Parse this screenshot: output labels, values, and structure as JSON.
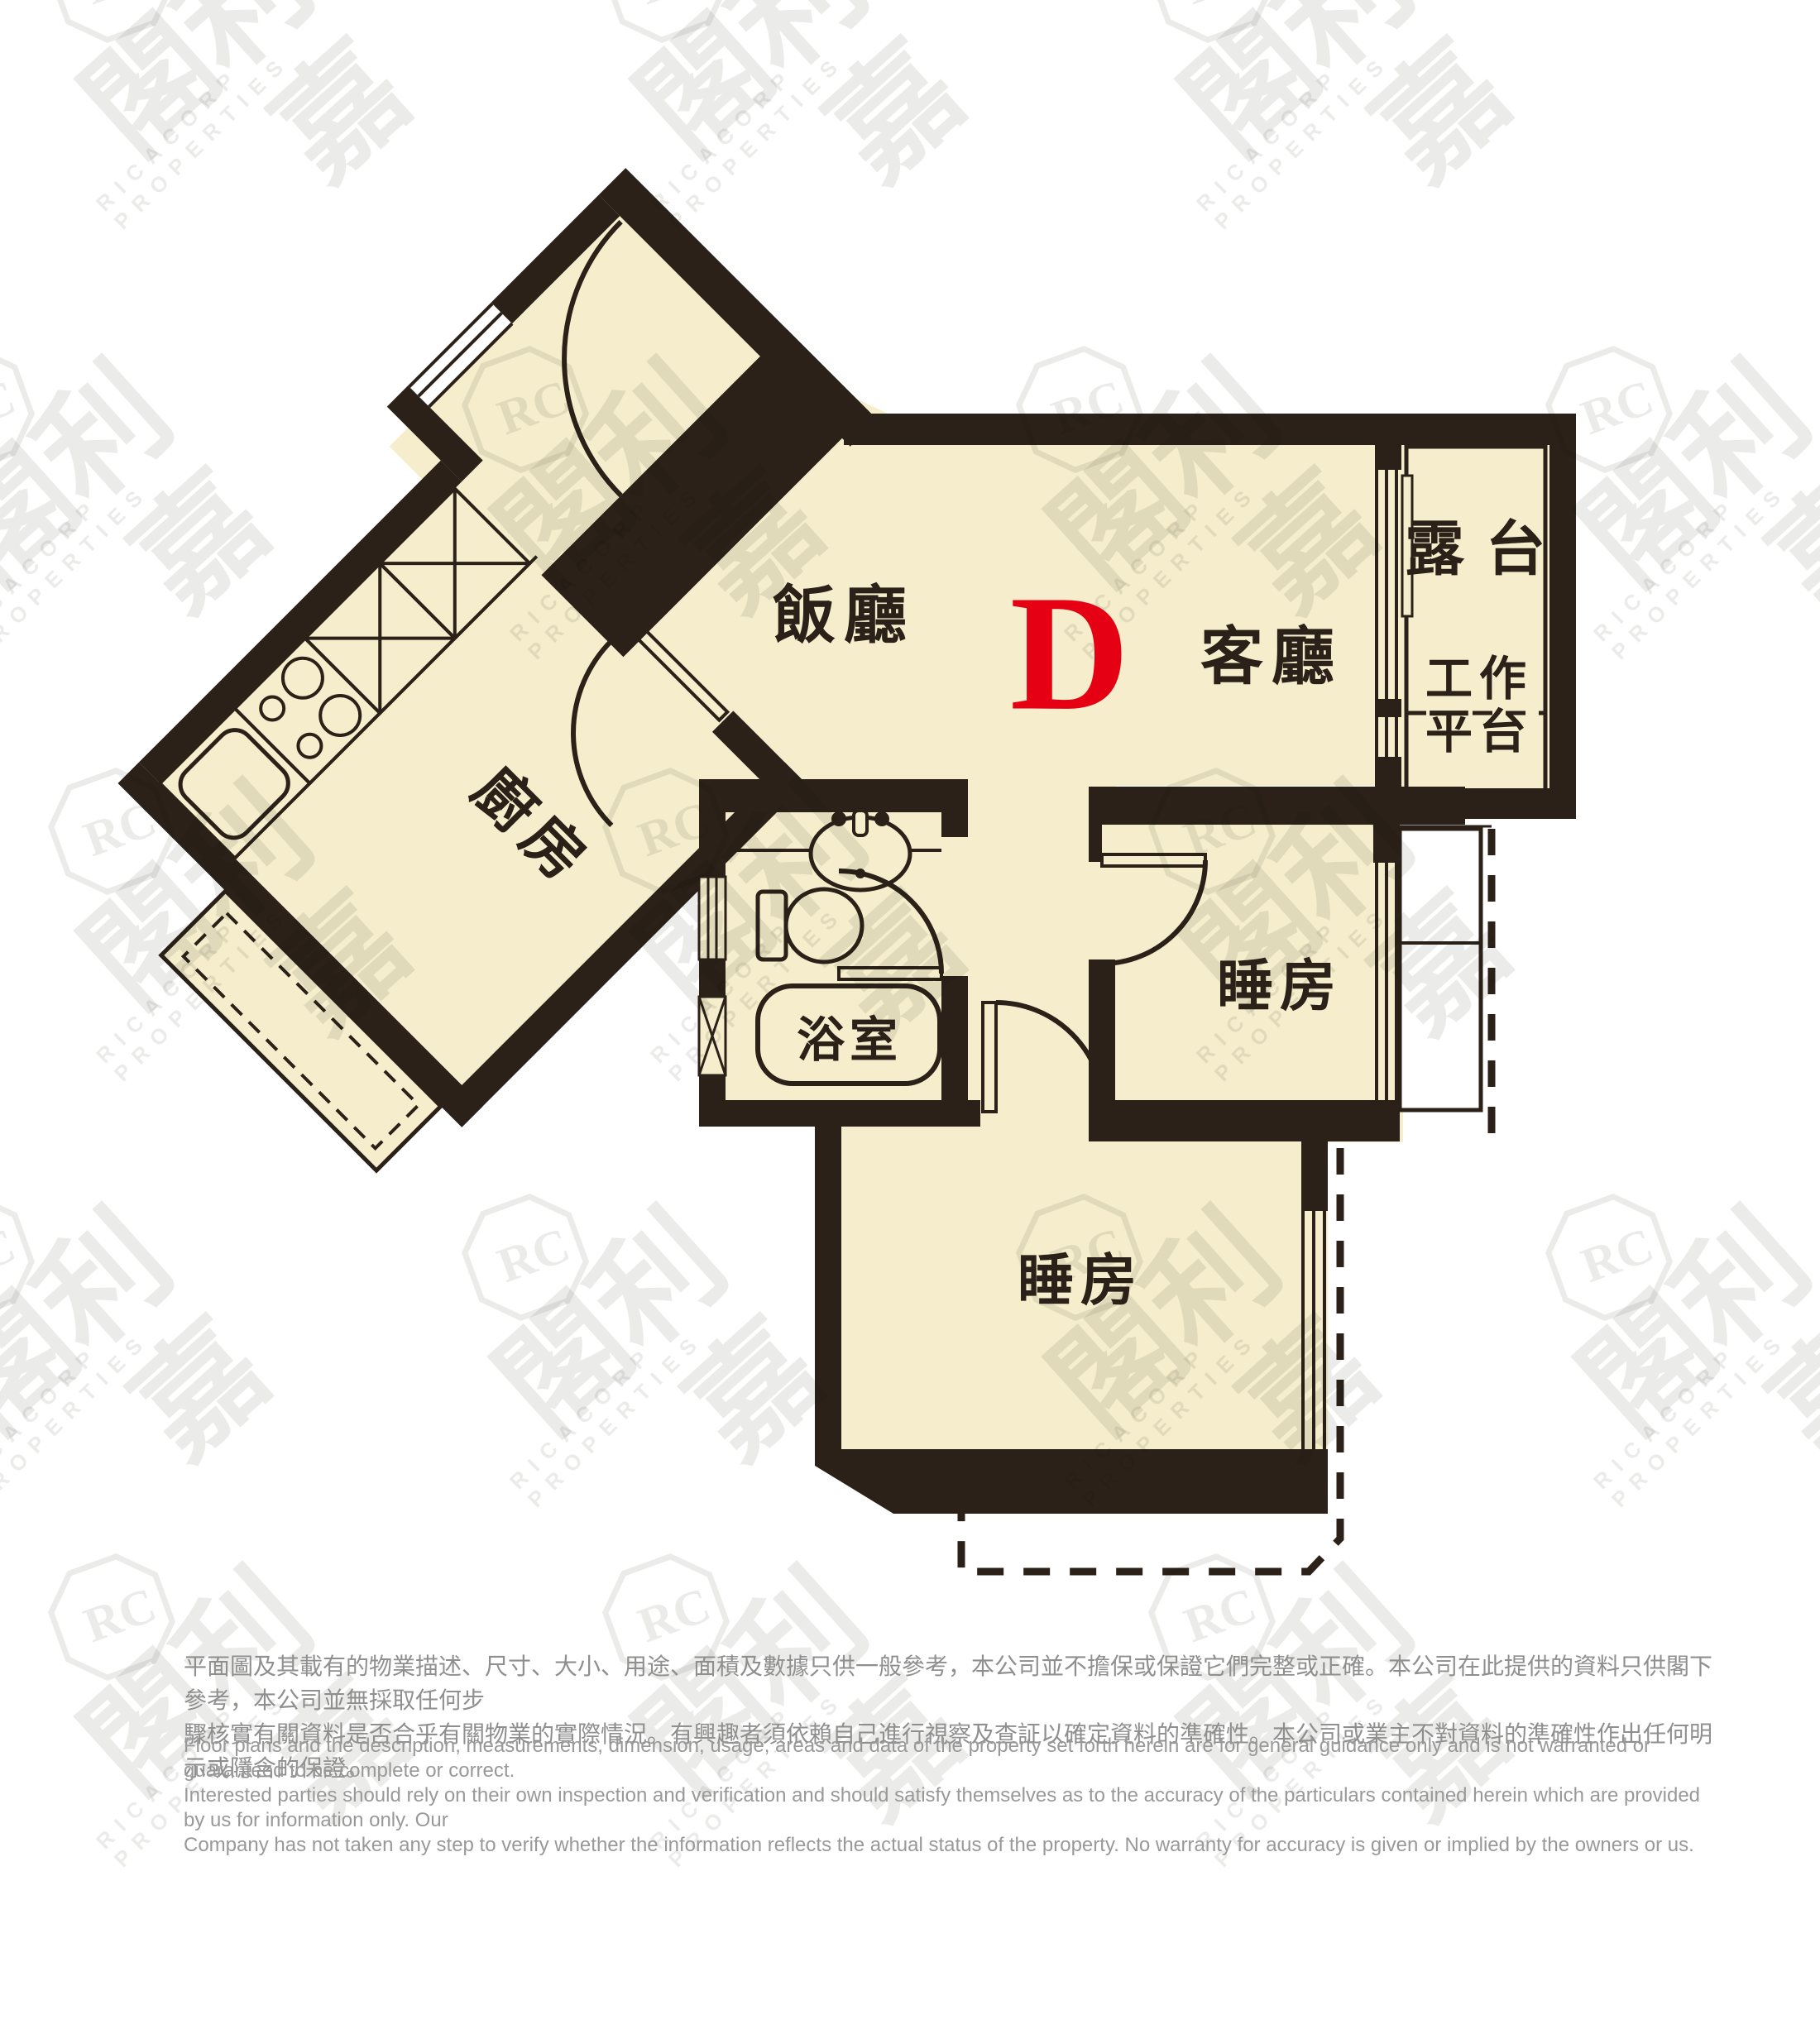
{
  "unit": {
    "label": "D"
  },
  "rooms": {
    "dining": "飯廳",
    "living": "客廳",
    "balcony": "露台",
    "utility": "工作\n平台",
    "kitchen": "廚房",
    "bathroom": "浴室",
    "bedroom1": "睡房",
    "bedroom2": "睡房"
  },
  "watermark": {
    "logo_text": "RC",
    "brand_cjk": "利嘉閣",
    "brand_en": "RICACORP PROPERTIES"
  },
  "disclaimer": {
    "chinese": "平面圖及其載有的物業描述、尺寸、大小、用途、面積及數據只供一般參考，本公司並不擔保或保證它們完整或正確。本公司在此提供的資料只供閣下參考，本公司並無採取任何步\n驟核實有關資料是否合乎有關物業的實際情況。有興趣者須依賴自己進行視察及查証以確定資料的準確性。本公司或業主不對資料的準確性作出任何明示或隱含的保證。",
    "english": "Floor plans and the description, measurements, dimension, usage, areas and data of the property set forth herein are for general guidance only and is not warranted or guaranteed to be complete or correct.\nInterested parties should rely on their own inspection and verification and should satisfy themselves as to the accuracy of the particulars contained herein which are provided by us for information only.  Our\nCompany has not taken any step to verify whether the information reflects the actual status of the property.  No warranty for accuracy is given or implied by the owners or us."
  },
  "colors": {
    "wall": "#2B2118",
    "floor": "#F5EDCB",
    "unit_red": "#E60013"
  }
}
